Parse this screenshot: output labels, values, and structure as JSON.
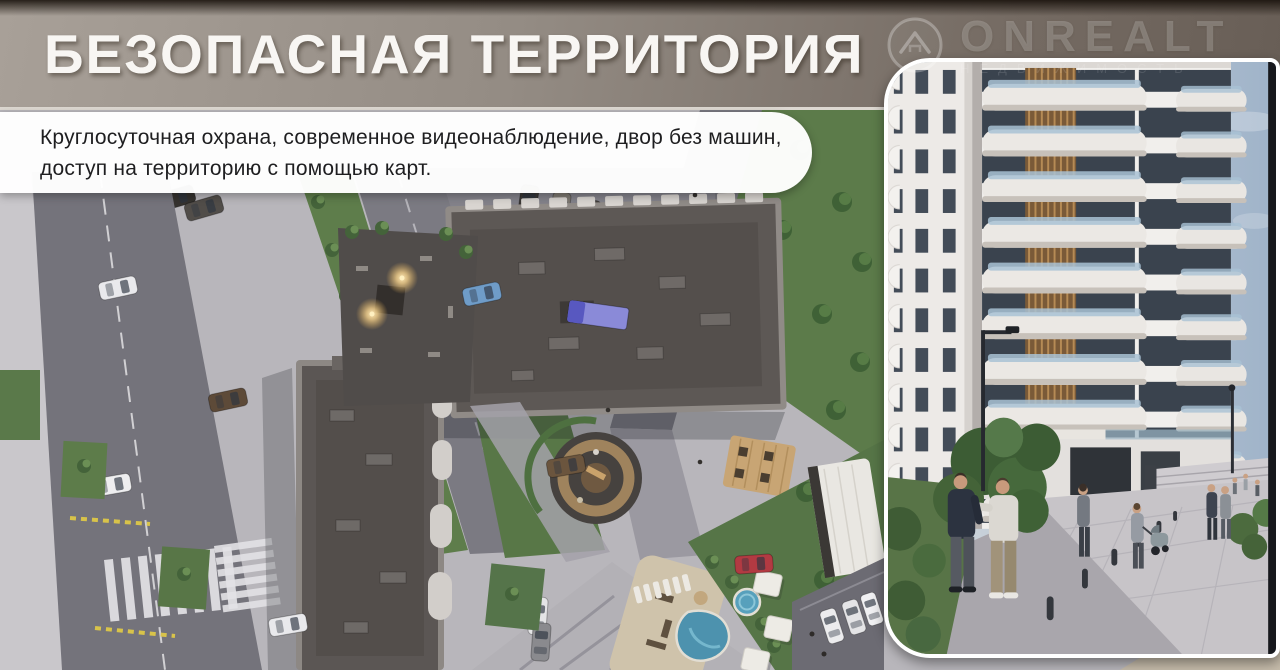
{
  "header": {
    "title": "БЕЗОПАСНАЯ ТЕРРИТОРИЯ"
  },
  "subtitle": {
    "line1": "Круглосуточная охрана, современное видеонаблюдение, двор без машин,",
    "line2": "доступ на территорию с помощью карт."
  },
  "watermark": {
    "brand": "ONREALT",
    "tagline": "НЕДВИЖИМОСТЬ",
    "icon": "house-in-circle-icon"
  },
  "colors": {
    "banner_left": "#a8a098",
    "banner_right": "#685e56",
    "banner_top_strip": "#19120c",
    "title_text": "#f8f6f3",
    "subtitle_text": "#1e1e20",
    "panel_border": "#ffffff",
    "grass": "#5c7b4a",
    "asphalt": "#74737b",
    "roof": "#5d5855",
    "pool": "#4d92ae",
    "courtyard_light": "#ffd98f"
  }
}
